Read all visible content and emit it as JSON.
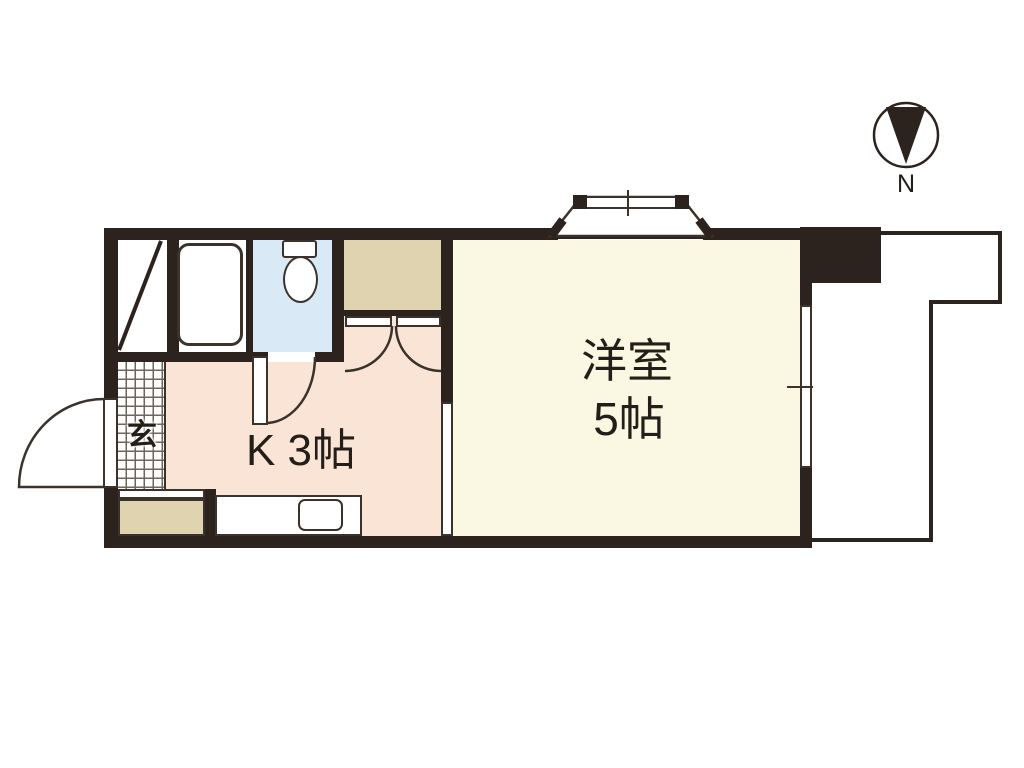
{
  "compass": {
    "north_label": "N"
  },
  "rooms": {
    "western": {
      "line1": "洋室",
      "line2": "5帖"
    },
    "kitchen": {
      "label": "K 3帖"
    },
    "genkan": {
      "label": "玄"
    }
  },
  "colors": {
    "wall": "#2D231E",
    "line": "#3A322B",
    "western-floor": "#FAF7E3",
    "kitchen-floor": "#FAE4D6",
    "closet-floor": "#DFD4AF",
    "toilet-floor": "#D9EAF6",
    "tile-grid-line": "#6E655C",
    "text": "#241E19",
    "background": "#FFFFFF"
  }
}
